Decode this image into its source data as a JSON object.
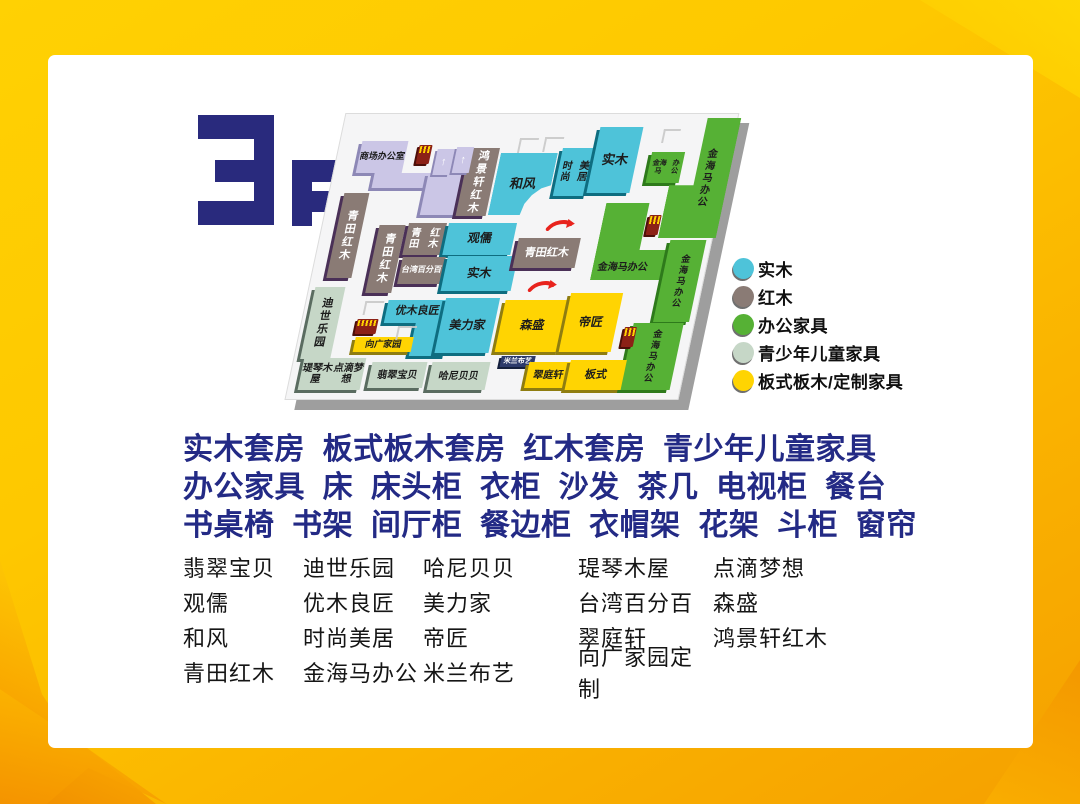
{
  "floor_label": "3F",
  "legend": {
    "items": [
      {
        "label": "实木",
        "color": "#4ec3d9"
      },
      {
        "label": "红木",
        "color": "#8a7b75"
      },
      {
        "label": "办公家具",
        "color": "#56b135"
      },
      {
        "label": "青少年儿童家具",
        "color": "#c6d7c7"
      },
      {
        "label": "板式板木/定制家具",
        "color": "#ffd402"
      }
    ]
  },
  "category_lines": [
    "实木套房  板式板木套房  红木套房  青少年儿童家具",
    "办公家具  床  床头柜  衣柜  沙发  茶几  电视柜  餐台",
    "书桌椅  书架  间厅柜  餐边柜  衣帽架  花架  斗柜  窗帘"
  ],
  "stores": {
    "rows": [
      [
        "翡翠宝贝",
        "迪世乐园",
        "哈尼贝贝",
        "瑅琴木屋",
        "点滴梦想"
      ],
      [
        "观儒",
        "优木良匠",
        "美力家",
        "台湾百分百",
        "森盛"
      ],
      [
        "和风",
        "时尚美居",
        "帝匠",
        "翠庭轩",
        "鸿景轩红木"
      ],
      [
        "青田红木",
        "金海马办公",
        "米兰布艺",
        "向广家园定制",
        ""
      ]
    ]
  },
  "map": {
    "blocks": [
      {
        "lines": [
          "商场",
          "办公室"
        ],
        "cat": "facility",
        "x": 23,
        "y": 26,
        "w": 46,
        "h": 32,
        "fs": 9
      },
      {
        "label": "",
        "cat": "facility",
        "x": 42,
        "y": 58,
        "w": 76,
        "h": 15
      },
      {
        "label": "",
        "cat": "facility",
        "x": 96,
        "y": 58,
        "w": 50,
        "h": 42
      },
      {
        "label": "鸿景轩红木",
        "cat": "redwood",
        "x": 132,
        "y": 33,
        "w": 30,
        "h": 68,
        "vertical": true,
        "fs": 11
      },
      {
        "label": "和风",
        "cat": "solidwood",
        "x": 164,
        "y": 38,
        "w": 57,
        "h": 62,
        "clip": "notch",
        "fs": 13
      },
      {
        "lines": [
          "时尚",
          "美居"
        ],
        "cat": "solidwood",
        "x": 225,
        "y": 33,
        "w": 34,
        "h": 48,
        "fs": 10
      },
      {
        "label": "实木",
        "cat": "solidwood",
        "x": 258,
        "y": 12,
        "w": 43,
        "h": 66,
        "fs": 13
      },
      {
        "lines": [
          "金海马",
          "办公"
        ],
        "cat": "office",
        "x": 315,
        "y": 37,
        "w": 33,
        "h": 31,
        "fs": 7
      },
      {
        "label": "金海马办公",
        "cat": "office",
        "x": 339,
        "y": 3,
        "w": 46,
        "h": 120,
        "vertical": true,
        "fs": 10,
        "clip": "stepTL"
      },
      {
        "label": "青田红木",
        "cat": "redwood",
        "x": 16,
        "y": 78,
        "w": 25,
        "h": 85,
        "vertical": true,
        "fs": 11
      },
      {
        "label": "青田红木",
        "cat": "redwood",
        "x": 58,
        "y": 110,
        "w": 26,
        "h": 68,
        "vertical": true,
        "fs": 11
      },
      {
        "lines": [
          "青田",
          "红木"
        ],
        "cat": "redwood",
        "x": 87,
        "y": 108,
        "w": 38,
        "h": 32,
        "fs": 10
      },
      {
        "label": "观儒",
        "cat": "solidwood",
        "x": 127,
        "y": 108,
        "w": 68,
        "h": 32,
        "fs": 12
      },
      {
        "label": "台湾百分百",
        "cat": "redwood",
        "x": 88,
        "y": 142,
        "w": 43,
        "h": 27,
        "fs": 8
      },
      {
        "label": "实木",
        "cat": "solidwood",
        "x": 133,
        "y": 141,
        "w": 70,
        "h": 35,
        "fs": 12
      },
      {
        "label": "青田红木",
        "cat": "redwood",
        "x": 200,
        "y": 123,
        "w": 62,
        "h": 30,
        "fs": 11
      },
      {
        "label": "金海马办公",
        "cat": "office",
        "x": 280,
        "y": 88,
        "w": 80,
        "h": 77,
        "clip": "L",
        "fs": 10,
        "lpos": "bl"
      },
      {
        "label": "金海马办公",
        "cat": "office",
        "x": 352,
        "y": 125,
        "w": 36,
        "h": 82,
        "vertical": true,
        "fs": 9
      },
      {
        "label": "金海马办公",
        "cat": "office",
        "x": 333,
        "y": 208,
        "w": 50,
        "h": 67,
        "vertical": true,
        "fs": 9
      },
      {
        "label": "迪世乐园",
        "cat": "kids",
        "x": 7,
        "y": 172,
        "w": 30,
        "h": 72,
        "vertical": true,
        "fs": 11
      },
      {
        "label": "优木良匠",
        "cat": "solidwood",
        "x": 83,
        "y": 185,
        "w": 62,
        "h": 23,
        "fs": 11
      },
      {
        "label": "",
        "cat": "solidwood",
        "x": 115,
        "y": 208,
        "w": 37,
        "h": 33
      },
      {
        "label": "美力家",
        "cat": "solidwood",
        "x": 140,
        "y": 183,
        "w": 54,
        "h": 55,
        "fs": 12
      },
      {
        "label": "向广家园",
        "cat": "panel",
        "x": 58,
        "y": 222,
        "w": 58,
        "h": 15,
        "fs": 9
      },
      {
        "label": "森盛",
        "cat": "panel",
        "x": 200,
        "y": 185,
        "w": 64,
        "h": 52,
        "fs": 12
      },
      {
        "label": "帝匠",
        "cat": "panel",
        "x": 264,
        "y": 178,
        "w": 52,
        "h": 59,
        "fs": 12
      },
      {
        "label": "米兰布艺",
        "cat": "navy",
        "x": 208,
        "y": 241,
        "w": 34,
        "h": 11,
        "fs": 7
      },
      {
        "label": "翠庭轩",
        "cat": "panel",
        "x": 237,
        "y": 247,
        "w": 43,
        "h": 26,
        "fs": 10
      },
      {
        "label": "板式",
        "cat": "panel",
        "x": 278,
        "y": 245,
        "w": 56,
        "h": 30,
        "fs": 11
      },
      {
        "lines": [
          "瑅琴木屋",
          "点滴梦想"
        ],
        "cat": "kids",
        "x": 11,
        "y": 243,
        "w": 62,
        "h": 32,
        "fs": 10
      },
      {
        "label": "翡翠宝贝",
        "cat": "kids",
        "x": 80,
        "y": 247,
        "w": 55,
        "h": 26,
        "fs": 10
      },
      {
        "label": "哈尼贝贝",
        "cat": "kids",
        "x": 140,
        "y": 247,
        "w": 58,
        "h": 28,
        "fs": 10
      }
    ],
    "facilities": [
      {
        "type": "elevator",
        "x": 81,
        "y": 30,
        "w": 13,
        "h": 19
      },
      {
        "type": "escalator",
        "x": 100,
        "y": 34,
        "w": 17,
        "h": 26
      },
      {
        "type": "escalator",
        "x": 119,
        "y": 32,
        "w": 17,
        "h": 26
      },
      {
        "type": "elevator",
        "x": 326,
        "y": 100,
        "w": 12,
        "h": 20
      },
      {
        "type": "elevator",
        "x": 56,
        "y": 204,
        "w": 21,
        "h": 15
      },
      {
        "type": "elevator",
        "x": 325,
        "y": 212,
        "w": 12,
        "h": 20
      },
      {
        "type": "arrow",
        "x": 224,
        "y": 103,
        "w": 30,
        "h": 13
      },
      {
        "type": "arrow",
        "x": 219,
        "y": 164,
        "w": 30,
        "h": 13
      },
      {
        "type": "stairs",
        "x": 180,
        "y": 23,
        "w": 17,
        "h": 13
      },
      {
        "type": "stairs",
        "x": 205,
        "y": 22,
        "w": 17,
        "h": 13
      },
      {
        "type": "stairs",
        "x": 322,
        "y": 14,
        "w": 15,
        "h": 12
      },
      {
        "type": "stairs",
        "x": 60,
        "y": 186,
        "w": 17,
        "h": 12
      },
      {
        "type": "stairs",
        "x": 98,
        "y": 211,
        "w": 17,
        "h": 12
      }
    ]
  }
}
